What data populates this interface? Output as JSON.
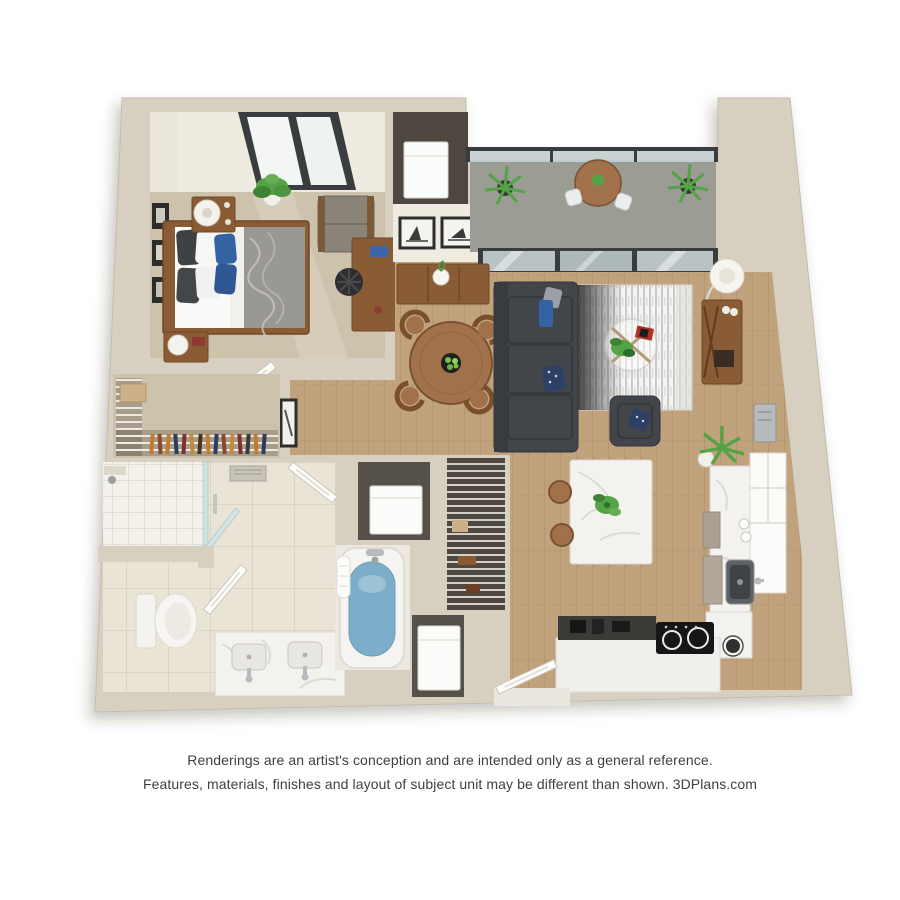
{
  "disclaimer": {
    "line1": "Renderings are an artist's conception and are intended only as a general reference.",
    "line2": "Features, materials, finishes and layout of subject unit may be different than shown. 3DPlans.com"
  },
  "palette": {
    "wall": "#d7d0c1",
    "wallface": "#efebe0",
    "carpet": "#cdc3ac",
    "wood": "#c0a27c",
    "tile": "#e9e4d6",
    "showertile": "#f3f1ea",
    "balcony": "#9b9c94",
    "darkcloset": "#4e4740",
    "sofa": "#42464b",
    "blue": "#3463a4",
    "navy": "#2e4066",
    "plant": "#55a347",
    "furnwood": "#8a5c35",
    "furnwood2": "#a0714a",
    "marble": "#f3f2ee",
    "steel": "#b7bbbd",
    "cooktop": "#161616",
    "water": "#7caec9",
    "appliance": "#fbfbfa",
    "framedark": "#2d2d2d",
    "glass": "#c7d2d4",
    "glassframe": "#393d3f",
    "textcolor": "#3f3f3f"
  },
  "floorplan": {
    "type": "3d-rendered-floor-plan",
    "rooms": [
      "bedroom",
      "walk-in-closet",
      "bathroom",
      "toilet-room",
      "shower",
      "utility-closet",
      "linen-closet",
      "washer-closet",
      "dryer-closet",
      "hallway",
      "dining-area",
      "living-room",
      "kitchen",
      "balcony",
      "entry"
    ],
    "furniture": {
      "bedroom": [
        "queen-bed",
        "nightstand-with-lamp",
        "nightstand-with-lamp",
        "potted-plant",
        "armchair",
        "desk-with-chair",
        "wall-art-x3",
        "angled-window"
      ],
      "walk_in_closet": [
        "wire-shelving",
        "hanging-clothes",
        "storage-box",
        "door"
      ],
      "bathroom": [
        "walk-in-shower",
        "exhaust-vent",
        "toilet",
        "double-sink-vanity",
        "bathtub-with-water",
        "towel",
        "doors"
      ],
      "living_room": [
        "sectional-sofa",
        "area-rug",
        "round-glass-coffee-table",
        "accent-armchair",
        "floor-lamp",
        "media-console",
        "sliding-glass-door"
      ],
      "dining_area": [
        "round-dining-table",
        "dining-chairs-x4",
        "centerpiece-bowl",
        "sideboard-with-vase",
        "framed-art-x2"
      ],
      "kitchen": [
        "marble-island",
        "bar-stools-x2",
        "counter-run",
        "stainless-sink",
        "black-cooktop",
        "white-cabinets",
        "coffee-station",
        "potted-plant",
        "wall-panel"
      ],
      "balcony": [
        "glass-railing",
        "round-cafe-table",
        "white-chairs",
        "potted-palms-x2"
      ],
      "utility_closet": [
        "water-heater-unit"
      ],
      "laundry": [
        "washer",
        "dryer",
        "wire-shelf-pantry"
      ]
    }
  }
}
